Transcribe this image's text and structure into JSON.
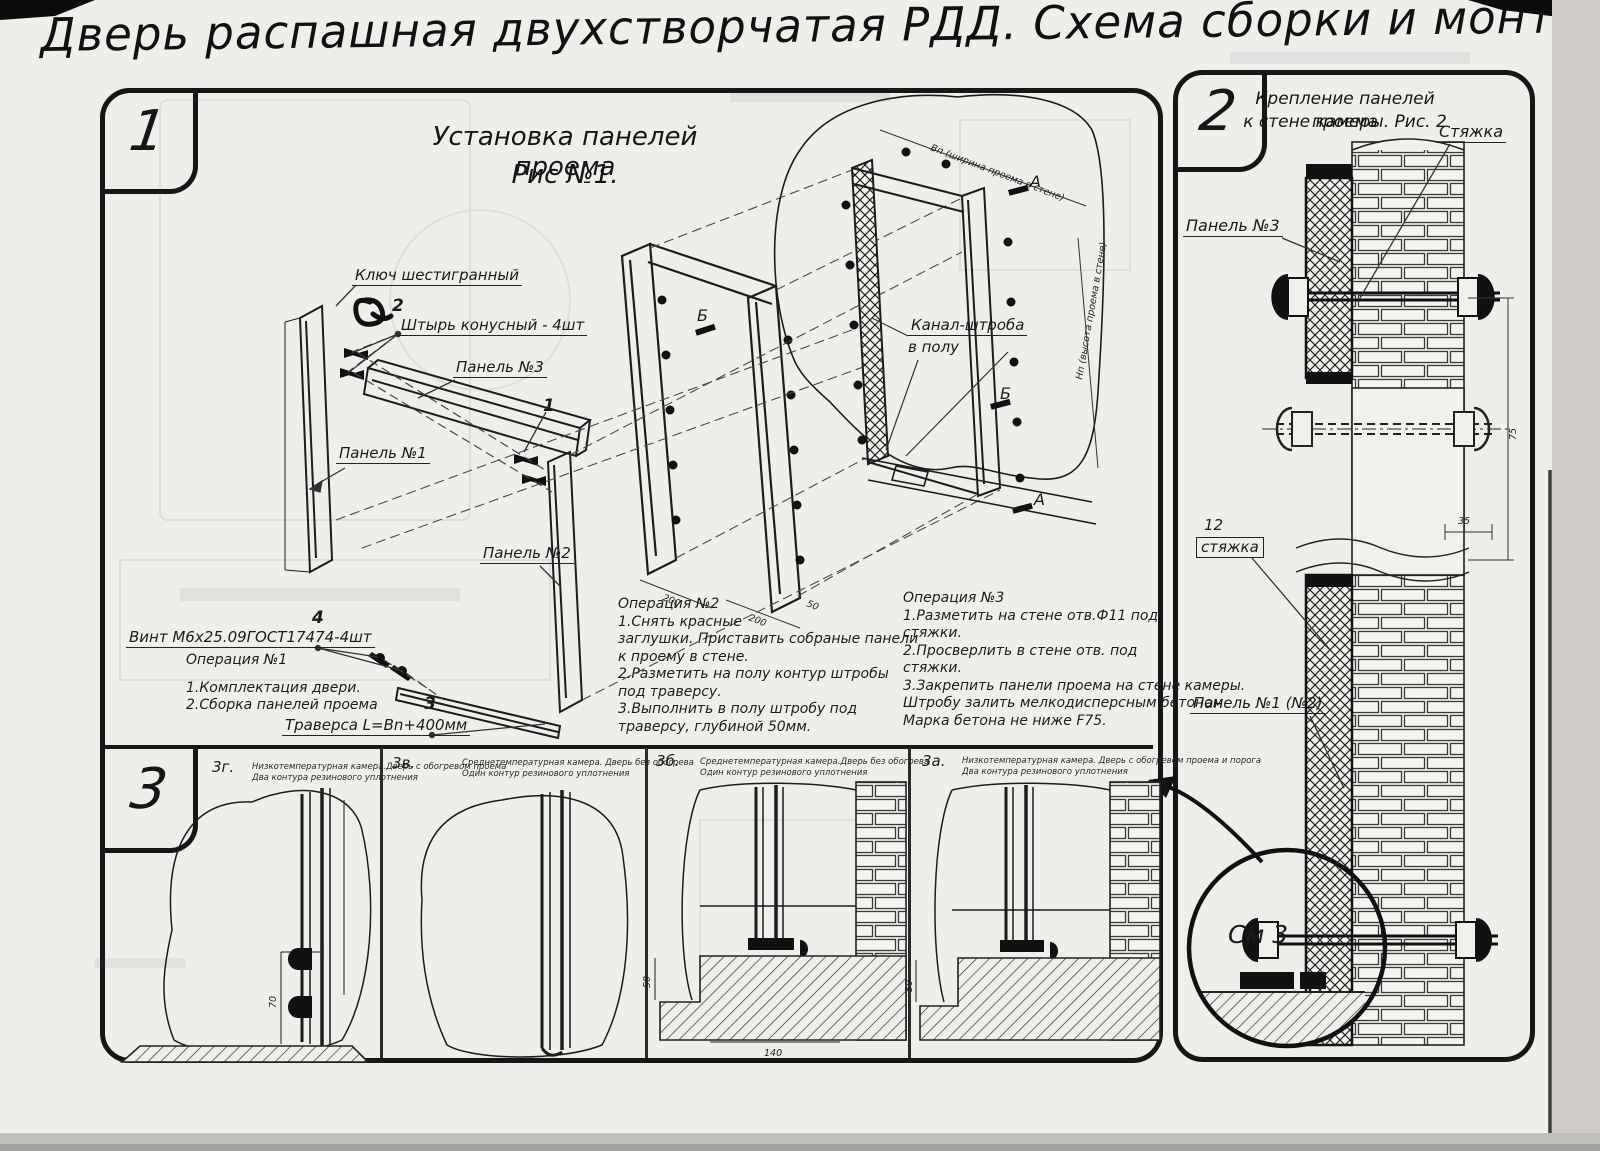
{
  "title": "Дверь распашная двухстворчатая РДД.  Схема сборки и монтажа №2",
  "sec1": {
    "number": "1",
    "heading1": "Установка панелей проема",
    "heading2": "Рис №1.",
    "labels": {
      "hex_key": "Ключ шестигранный",
      "pin_num": "2",
      "pin": "Штырь конусный - 4шт",
      "panel3": "Панель №3",
      "panel1": "Панель №1",
      "callout1": "1",
      "panel2": "Панель №2",
      "screw": "Винт М6х25.09ГОСТ17474-4шт",
      "screw_num": "4",
      "traverse": "Траверса  L=Bn+400мм",
      "traverse_num": "3",
      "section_a": "А",
      "section_b": "Б",
      "channel1": "Канал-штроба",
      "channel2": "в полу",
      "dim_w": "Вп (ширина проема в стене)",
      "dim_h": "Нп (высота проема в стене)",
      "dim200": "200",
      "dim50": "50"
    },
    "op1": {
      "title": "Операция №1",
      "lines": [
        "1.Комплектация двери.",
        "2.Сборка панелей проема"
      ]
    },
    "op2": {
      "title": "Операция №2",
      "lines": [
        "1.Снять красные",
        "заглушки. Приставить собраные панели",
        "к проему в стене.",
        "2.Разметить на полу контур штробы",
        "под траверсу.",
        "3.Выполнить в полу штробу под",
        "траверсу, глубиной 50мм."
      ]
    },
    "op3": {
      "title": "Операция №3",
      "lines": [
        "1.Разметить на стене отв.Ф11 под",
        "стяжки.",
        "2.Просверлить в стене отв.  под",
        "стяжки.",
        "3.Закрепить панели проема на стене камеры.",
        "Штробу залить мелкодисперсным бетоном",
        "Марка бетона не ниже   F75."
      ]
    }
  },
  "sec2": {
    "number": "2",
    "heading1": "Крепление панелей проема",
    "heading2": "к стене камеры. Рис. 2",
    "labels": {
      "tie": "Стяжка",
      "panel3": "Панель №3",
      "tie_num": "12",
      "tie_box": "стяжка",
      "panel12": "Панель №1 (№2)",
      "see3": "См 3",
      "dim75": "75",
      "dim35": "35"
    }
  },
  "sec3": {
    "number": "3",
    "cells": [
      {
        "id": "3г.",
        "cap1": "Низкотемпературная камера.Дверь с обогревом проема",
        "cap2": "Два контура резинового уплотнения",
        "dim70": "70"
      },
      {
        "id": "3в.",
        "cap1": "Среднетемпературная камера. Дверь без обогрева",
        "cap2": "Один контур резинового уплотнения"
      },
      {
        "id": "3б.",
        "cap1": "Среднетемпературная камера.Дверь без обогрева",
        "cap2": "Один контур резинового уплотнения",
        "dim50": "50",
        "dim140": "140"
      },
      {
        "id": "3а.",
        "cap1": "Низкотемпературная камера. Дверь с обогревом проема и порога",
        "cap2": "Два контура резинового уплотнения",
        "dim50": "50"
      }
    ]
  }
}
